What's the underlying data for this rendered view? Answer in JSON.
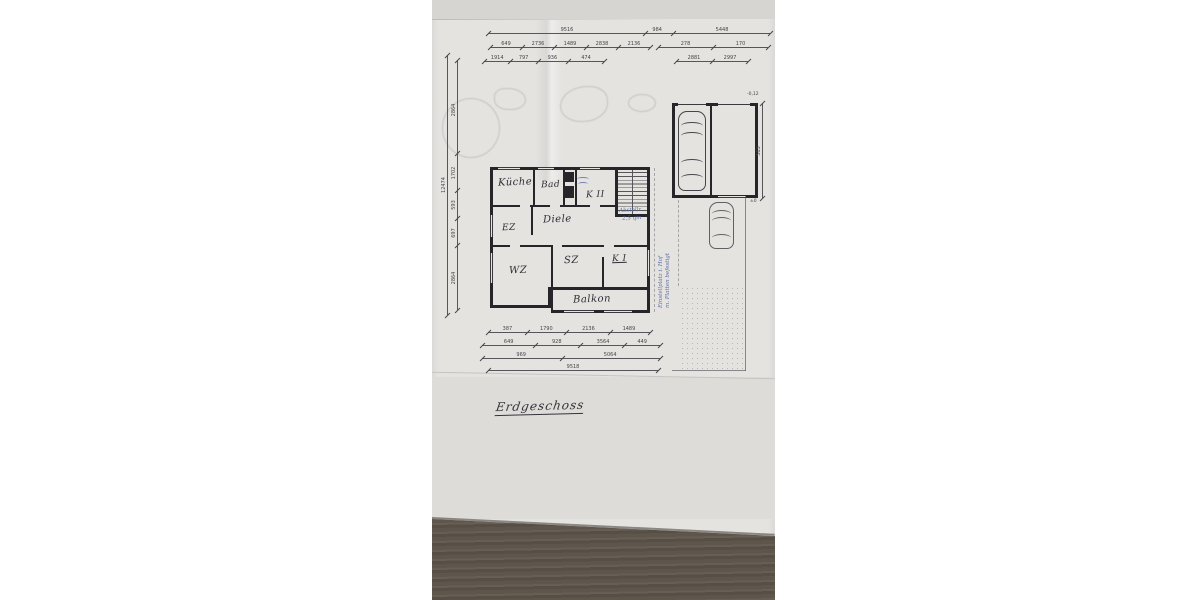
{
  "scene": {
    "description": "Photograph of a hand-drawn German ground-floor plan on paper lying on a wooden table",
    "colors": {
      "page_margin": "#ffffff",
      "paper": "#e5e3e0",
      "lower_sheet": "#dedcd9",
      "ink": "#26262a",
      "dimension_ink": "#45454a",
      "pen_blue": "#5c6fa8",
      "wood_table": "#5e554b"
    }
  },
  "title_note": {
    "text": "Erdgeschoss"
  },
  "floor_plan": {
    "rooms": [
      {
        "id": "kueche",
        "label": "Küche",
        "x": 66,
        "y": 177,
        "size": 10
      },
      {
        "id": "bad",
        "label": "Bad",
        "x": 109,
        "y": 180,
        "size": 9
      },
      {
        "id": "kind2",
        "label": "K II",
        "x": 154,
        "y": 190,
        "size": 9
      },
      {
        "id": "ez",
        "label": "EZ",
        "x": 70,
        "y": 223,
        "size": 9
      },
      {
        "id": "diele",
        "label": "Diele",
        "x": 111,
        "y": 214,
        "size": 10
      },
      {
        "id": "wz",
        "label": "WZ",
        "x": 77,
        "y": 265,
        "size": 10
      },
      {
        "id": "sz",
        "label": "SZ",
        "x": 132,
        "y": 255,
        "size": 10
      },
      {
        "id": "kind1",
        "label": "K I",
        "x": 180,
        "y": 254,
        "size": 9,
        "ul": true
      },
      {
        "id": "balkon",
        "label": "Balkon",
        "x": 141,
        "y": 294,
        "size": 10
      }
    ]
  },
  "annotations": [
    {
      "id": "stair-note-1",
      "text": "Abstellr.",
      "x": 187,
      "y": 208,
      "size": 5.5,
      "rot": -3
    },
    {
      "id": "stair-note-2",
      "text": "2,5 qm",
      "x": 190,
      "y": 216,
      "size": 5.5,
      "rot": -3
    },
    {
      "id": "yard-note-1",
      "text": "Einstellplatz i. Hof",
      "x": 226,
      "y": 308,
      "size": 5.5,
      "rot": -90
    },
    {
      "id": "yard-note-2",
      "text": "m. Platten befestigt",
      "x": 233,
      "y": 308,
      "size": 5.5,
      "rot": -90
    }
  ],
  "dimensions": {
    "chains": [
      {
        "o": "h",
        "x": 56,
        "y": 33,
        "len": 282,
        "ticks": [
          0,
          0.555,
          0.655,
          1
        ],
        "labels": [
          {
            "t": "9516",
            "f": 0.28
          },
          {
            "t": "984",
            "f": 0.6
          },
          {
            "t": "5448",
            "f": 0.83
          }
        ]
      },
      {
        "o": "h",
        "x": 58,
        "y": 47,
        "len": 160,
        "ticks": [
          0,
          0.2,
          0.4,
          0.6,
          0.8,
          1
        ],
        "labels": [
          {
            "t": "649",
            "f": 0.1
          },
          {
            "t": "2736",
            "f": 0.3
          },
          {
            "t": "1489",
            "f": 0.5
          },
          {
            "t": "2838",
            "f": 0.7
          },
          {
            "t": "2136",
            "f": 0.9
          }
        ]
      },
      {
        "o": "h",
        "x": 226,
        "y": 47,
        "len": 110,
        "ticks": [
          0,
          0.5,
          1
        ],
        "labels": [
          {
            "t": "278",
            "f": 0.25
          },
          {
            "t": "170",
            "f": 0.75
          }
        ]
      },
      {
        "o": "h",
        "x": 52,
        "y": 61,
        "len": 120,
        "ticks": [
          0,
          0.22,
          0.45,
          0.7,
          1
        ],
        "labels": [
          {
            "t": "1914",
            "f": 0.11
          },
          {
            "t": "797",
            "f": 0.33
          },
          {
            "t": "936",
            "f": 0.57
          },
          {
            "t": "474",
            "f": 0.85
          }
        ]
      },
      {
        "o": "h",
        "x": 244,
        "y": 61,
        "len": 72,
        "ticks": [
          0,
          0.5,
          1
        ],
        "labels": [
          {
            "t": "2881",
            "f": 0.25
          },
          {
            "t": "2997",
            "f": 0.75
          }
        ]
      },
      {
        "o": "h",
        "x": 56,
        "y": 332,
        "len": 162,
        "ticks": [
          0,
          0.24,
          0.48,
          0.75,
          1
        ],
        "labels": [
          {
            "t": "387",
            "f": 0.12
          },
          {
            "t": "1790",
            "f": 0.36
          },
          {
            "t": "2136",
            "f": 0.62
          },
          {
            "t": "1489",
            "f": 0.87
          }
        ]
      },
      {
        "o": "h",
        "x": 50,
        "y": 345,
        "len": 178,
        "ticks": [
          0,
          0.3,
          0.55,
          0.8,
          1
        ],
        "labels": [
          {
            "t": "649",
            "f": 0.15
          },
          {
            "t": "928",
            "f": 0.42
          },
          {
            "t": "3564",
            "f": 0.68
          },
          {
            "t": "449",
            "f": 0.9
          }
        ]
      },
      {
        "o": "h",
        "x": 50,
        "y": 358,
        "len": 178,
        "ticks": [
          0,
          0.45,
          1
        ],
        "labels": [
          {
            "t": "969",
            "f": 0.22
          },
          {
            "t": "5064",
            "f": 0.72
          }
        ]
      },
      {
        "o": "h",
        "x": 56,
        "y": 370,
        "len": 170,
        "ticks": [
          0,
          1
        ],
        "labels": [
          {
            "t": "9518",
            "f": 0.5
          }
        ]
      },
      {
        "o": "v",
        "x": 15,
        "y": 55,
        "len": 260,
        "ticks": [
          0,
          1
        ],
        "labels": [
          {
            "t": "12474",
            "f": 0.5
          }
        ]
      },
      {
        "o": "v",
        "x": 25,
        "y": 60,
        "len": 250,
        "ticks": [
          0,
          0.37,
          0.52,
          0.63,
          0.74,
          1
        ],
        "labels": [
          {
            "t": "2864",
            "f": 0.2
          },
          {
            "t": "1702",
            "f": 0.45
          },
          {
            "t": "593",
            "f": 0.58
          },
          {
            "t": "697",
            "f": 0.69
          },
          {
            "t": "2864",
            "f": 0.87
          }
        ]
      },
      {
        "o": "v",
        "x": 330,
        "y": 103,
        "len": 95,
        "ticks": [
          0,
          1
        ],
        "labels": [
          {
            "t": "583",
            "f": 0.5
          }
        ]
      }
    ],
    "marks": [
      {
        "t": "-0,12",
        "x": 315,
        "y": 92
      },
      {
        "t": "±0",
        "x": 318,
        "y": 199
      }
    ]
  }
}
